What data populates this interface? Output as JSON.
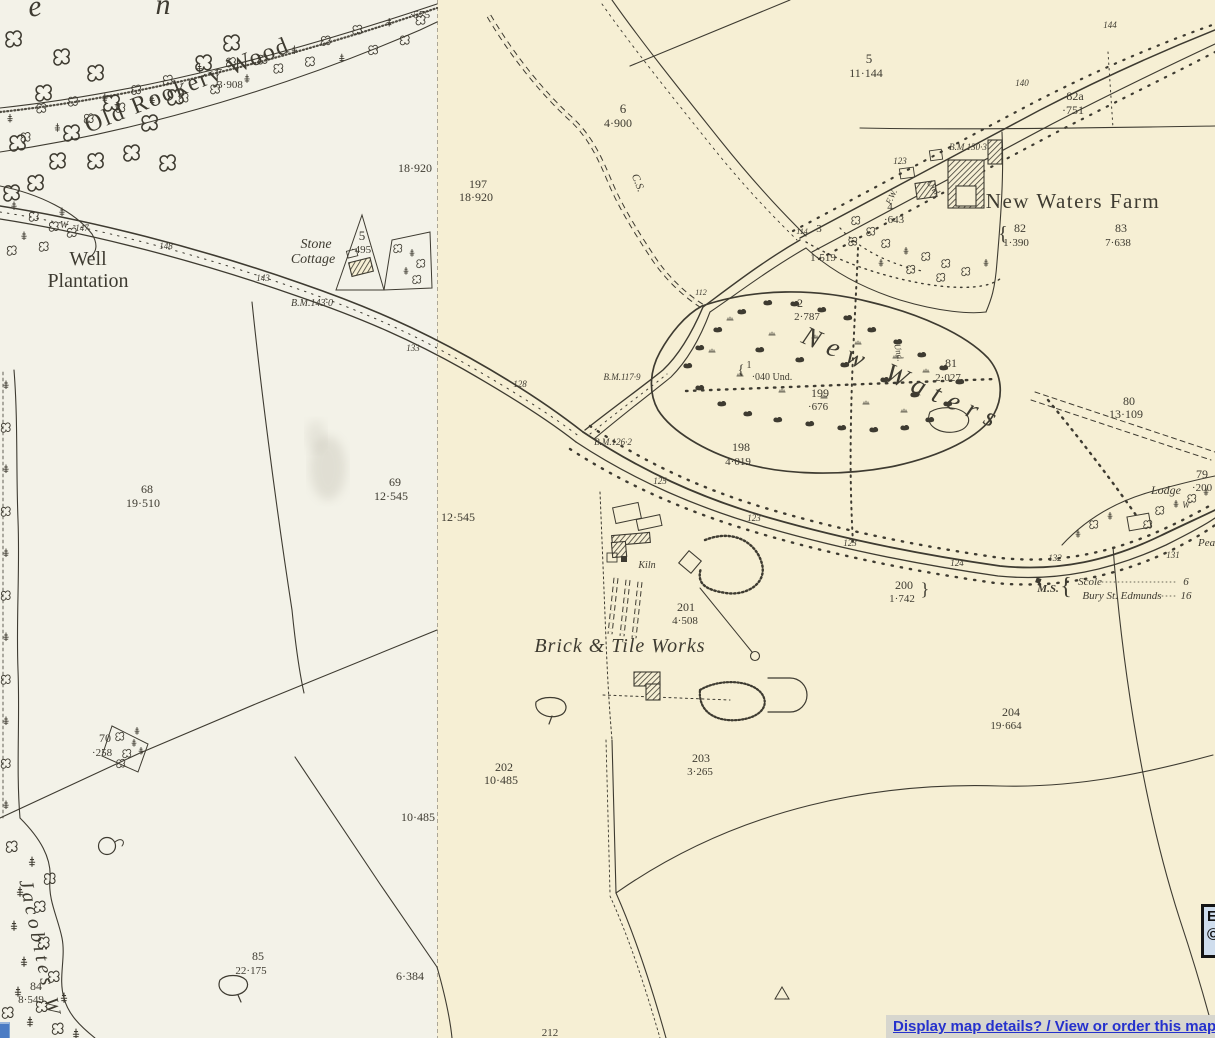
{
  "overlay": {
    "details_link": "Display map details? / View or order this map?",
    "edge_box": {
      "line1": "E",
      "line2": "©"
    }
  },
  "map": {
    "ink": "#3e3b31",
    "link_color": "#2531cd",
    "tiles": {
      "left_bg": "#f3f2e8",
      "right_bg": "#f6efd4"
    },
    "labels": [
      {
        "t": "e",
        "x": 36,
        "y": 16,
        "s": 30,
        "i": 1,
        "rot": -8
      },
      {
        "t": "n",
        "x": 163,
        "y": 14,
        "s": 30,
        "i": 1
      },
      {
        "t": "Old Rookery Wood",
        "x": 190,
        "y": 92,
        "s": 24,
        "rot": -22,
        "ls": 2
      },
      {
        "t": "7",
        "x": 219,
        "y": 76,
        "s": 10,
        "i": 1
      },
      {
        "t": "3·908",
        "x": 230,
        "y": 88,
        "s": 11
      },
      {
        "t": "·575",
        "x": 420,
        "y": 18,
        "s": 11
      },
      {
        "t": "18·920",
        "x": 415,
        "y": 172,
        "s": 12
      },
      {
        "t": "197",
        "x": 478,
        "y": 188,
        "s": 12
      },
      {
        "t": "18·920",
        "x": 476,
        "y": 201,
        "s": 12
      },
      {
        "t": "Well",
        "x": 88,
        "y": 265,
        "s": 20
      },
      {
        "t": "Plantation",
        "x": 88,
        "y": 287,
        "s": 20
      },
      {
        "t": "W",
        "x": 64,
        "y": 228,
        "s": 10,
        "i": 1
      },
      {
        "t": "147",
        "x": 82,
        "y": 231,
        "s": 9,
        "i": 1
      },
      {
        "t": "148",
        "x": 166,
        "y": 249,
        "s": 9,
        "i": 1
      },
      {
        "t": "143",
        "x": 263,
        "y": 281,
        "s": 9,
        "i": 1
      },
      {
        "t": "133",
        "x": 413,
        "y": 351,
        "s": 9,
        "i": 1
      },
      {
        "t": "Stone",
        "x": 316,
        "y": 248,
        "s": 14,
        "i": 1
      },
      {
        "t": "Cottage",
        "x": 313,
        "y": 263,
        "s": 14,
        "i": 1
      },
      {
        "t": "5",
        "x": 362,
        "y": 240,
        "s": 13
      },
      {
        "t": "·495",
        "x": 361,
        "y": 253,
        "s": 11
      },
      {
        "t": "B.M.143·0",
        "x": 312,
        "y": 306,
        "s": 10,
        "i": 1
      },
      {
        "t": "6",
        "x": 623,
        "y": 113,
        "s": 13
      },
      {
        "t": "4·900",
        "x": 618,
        "y": 127,
        "s": 12
      },
      {
        "t": "C.S.",
        "x": 635,
        "y": 184,
        "s": 11,
        "i": 1,
        "rot": 68
      },
      {
        "t": "5",
        "x": 869,
        "y": 63,
        "s": 13
      },
      {
        "t": "11·144",
        "x": 866,
        "y": 77,
        "s": 12
      },
      {
        "t": "144",
        "x": 1110,
        "y": 28,
        "s": 9,
        "i": 1
      },
      {
        "t": "140",
        "x": 1022,
        "y": 86,
        "s": 9,
        "i": 1
      },
      {
        "t": "82a",
        "x": 1075,
        "y": 100,
        "s": 12
      },
      {
        "t": "·751",
        "x": 1073,
        "y": 114,
        "s": 12
      },
      {
        "t": "B.M.130·3",
        "x": 968,
        "y": 150,
        "s": 9,
        "i": 1
      },
      {
        "t": "123",
        "x": 900,
        "y": 164,
        "s": 9,
        "i": 1
      },
      {
        "t": "Und",
        "x": 931,
        "y": 189,
        "s": 9,
        "i": 1,
        "rot": 55
      },
      {
        "t": "F.W.",
        "x": 894,
        "y": 198,
        "s": 9,
        "i": 1,
        "rot": -65
      },
      {
        "t": "4",
        "x": 890,
        "y": 210,
        "s": 11
      },
      {
        "t": "·643",
        "x": 894,
        "y": 223,
        "s": 11
      },
      {
        "t": "New Waters Farm",
        "x": 1073,
        "y": 208,
        "s": 21,
        "ls": 1.5
      },
      {
        "t": "{",
        "x": 1003,
        "y": 240,
        "s": 20
      },
      {
        "t": "82",
        "x": 1020,
        "y": 232,
        "s": 12
      },
      {
        "t": "1·390",
        "x": 1016,
        "y": 246,
        "s": 11
      },
      {
        "t": "83",
        "x": 1121,
        "y": 232,
        "s": 12
      },
      {
        "t": "7·638",
        "x": 1118,
        "y": 246,
        "s": 11
      },
      {
        "t": "114",
        "x": 802,
        "y": 234,
        "s": 8,
        "i": 1
      },
      {
        "t": "3",
        "x": 819,
        "y": 232,
        "s": 11
      },
      {
        "t": "1·519",
        "x": 823,
        "y": 261,
        "s": 11
      },
      {
        "t": "112",
        "x": 701,
        "y": 295,
        "s": 8,
        "i": 1
      },
      {
        "t": "2",
        "x": 800,
        "y": 307,
        "s": 12
      },
      {
        "t": "2·787",
        "x": 807,
        "y": 320,
        "s": 11
      },
      {
        "t": "New Waters",
        "x": 800,
        "y": 342,
        "s": 27,
        "i": 1,
        "rot": 24,
        "ls": 9,
        "a": "start"
      },
      {
        "t": "Und.",
        "x": 896,
        "y": 353,
        "s": 9,
        "i": 1,
        "rot": 78
      },
      {
        "t": "1",
        "x": 749,
        "y": 368,
        "s": 10
      },
      {
        "t": "{",
        "x": 741,
        "y": 374,
        "s": 14
      },
      {
        "t": "·040 Und.",
        "x": 772,
        "y": 380,
        "s": 10
      },
      {
        "t": "81",
        "x": 951,
        "y": 367,
        "s": 12
      },
      {
        "t": "2·027",
        "x": 948,
        "y": 381,
        "s": 11
      },
      {
        "t": "199",
        "x": 820,
        "y": 397,
        "s": 12
      },
      {
        "t": "·676",
        "x": 818,
        "y": 410,
        "s": 11
      },
      {
        "t": "B.M.117·9",
        "x": 622,
        "y": 380,
        "s": 9,
        "i": 1
      },
      {
        "t": "128",
        "x": 520,
        "y": 387,
        "s": 9,
        "i": 1
      },
      {
        "t": "B.M.126·2",
        "x": 613,
        "y": 445,
        "s": 9,
        "i": 1
      },
      {
        "t": "198",
        "x": 741,
        "y": 451,
        "s": 12
      },
      {
        "t": "4·019",
        "x": 738,
        "y": 465,
        "s": 11
      },
      {
        "t": "125",
        "x": 660,
        "y": 484,
        "s": 9,
        "i": 1
      },
      {
        "t": "68",
        "x": 147,
        "y": 493,
        "s": 12
      },
      {
        "t": "19·510",
        "x": 143,
        "y": 507,
        "s": 12
      },
      {
        "t": "69",
        "x": 395,
        "y": 486,
        "s": 12
      },
      {
        "t": "12·545",
        "x": 391,
        "y": 500,
        "s": 12
      },
      {
        "t": "12·545",
        "x": 458,
        "y": 521,
        "s": 12
      },
      {
        "t": "123",
        "x": 754,
        "y": 521,
        "s": 9,
        "i": 1
      },
      {
        "t": "Kiln",
        "x": 647,
        "y": 568,
        "s": 10,
        "i": 1
      },
      {
        "t": "201",
        "x": 686,
        "y": 611,
        "s": 12
      },
      {
        "t": "4·508",
        "x": 685,
        "y": 624,
        "s": 11
      },
      {
        "t": "Brick & Tile Works",
        "x": 620,
        "y": 652,
        "s": 20,
        "i": 1,
        "ls": 1
      },
      {
        "t": "200",
        "x": 904,
        "y": 589,
        "s": 12
      },
      {
        "t": "1·742",
        "x": 902,
        "y": 602,
        "s": 11
      },
      {
        "t": "}",
        "x": 925,
        "y": 595,
        "s": 18
      },
      {
        "t": "124",
        "x": 957,
        "y": 566,
        "s": 9,
        "i": 1
      },
      {
        "t": "132",
        "x": 1055,
        "y": 561,
        "s": 9,
        "i": 1
      },
      {
        "t": "123",
        "x": 850,
        "y": 546,
        "s": 9,
        "i": 1
      },
      {
        "t": "131",
        "x": 1173,
        "y": 558,
        "s": 9,
        "i": 1
      },
      {
        "t": "M.S.",
        "x": 1048,
        "y": 592,
        "s": 11,
        "i": 1,
        "b": 1
      },
      {
        "t": "{",
        "x": 1066,
        "y": 594,
        "s": 24
      },
      {
        "t": "Scole",
        "x": 1090,
        "y": 585,
        "s": 11,
        "i": 1
      },
      {
        "t": "6",
        "x": 1186,
        "y": 585,
        "s": 11,
        "i": 1
      },
      {
        "t": "Bury St. Edmunds",
        "x": 1122,
        "y": 599,
        "s": 11,
        "i": 1
      },
      {
        "t": "16",
        "x": 1186,
        "y": 599,
        "s": 11,
        "i": 1
      },
      {
        "t": "80",
        "x": 1129,
        "y": 405,
        "s": 12
      },
      {
        "t": "13·109",
        "x": 1126,
        "y": 418,
        "s": 12
      },
      {
        "t": "79",
        "x": 1202,
        "y": 478,
        "s": 12
      },
      {
        "t": "·200",
        "x": 1202,
        "y": 491,
        "s": 11
      },
      {
        "t": "Lodge",
        "x": 1166,
        "y": 494,
        "s": 12,
        "i": 1
      },
      {
        "t": "W",
        "x": 1186,
        "y": 508,
        "s": 9,
        "i": 1
      },
      {
        "t": "Pea",
        "x": 1198,
        "y": 546,
        "s": 11,
        "i": 1,
        "a": "start"
      },
      {
        "t": "70",
        "x": 105,
        "y": 742,
        "s": 12
      },
      {
        "t": "·258",
        "x": 102,
        "y": 756,
        "s": 11
      },
      {
        "t": "202",
        "x": 504,
        "y": 771,
        "s": 12
      },
      {
        "t": "10·485",
        "x": 501,
        "y": 784,
        "s": 12
      },
      {
        "t": "10·485",
        "x": 418,
        "y": 821,
        "s": 12
      },
      {
        "t": "203",
        "x": 701,
        "y": 762,
        "s": 12
      },
      {
        "t": "3·265",
        "x": 700,
        "y": 775,
        "s": 11
      },
      {
        "t": "6·384",
        "x": 410,
        "y": 980,
        "s": 12
      },
      {
        "t": "85",
        "x": 258,
        "y": 960,
        "s": 12
      },
      {
        "t": "22·175",
        "x": 251,
        "y": 974,
        "s": 11
      },
      {
        "t": "84",
        "x": 36,
        "y": 990,
        "s": 12
      },
      {
        "t": "8·549",
        "x": 31,
        "y": 1003,
        "s": 11
      },
      {
        "t": "Jacobites W",
        "x": 34,
        "y": 950,
        "s": 20,
        "i": 1,
        "rot": 78,
        "ls": 4
      },
      {
        "t": "204",
        "x": 1011,
        "y": 716,
        "s": 12
      },
      {
        "t": "19·664",
        "x": 1006,
        "y": 729,
        "s": 11
      },
      {
        "t": "212",
        "x": 550,
        "y": 1036,
        "s": 11
      }
    ]
  }
}
